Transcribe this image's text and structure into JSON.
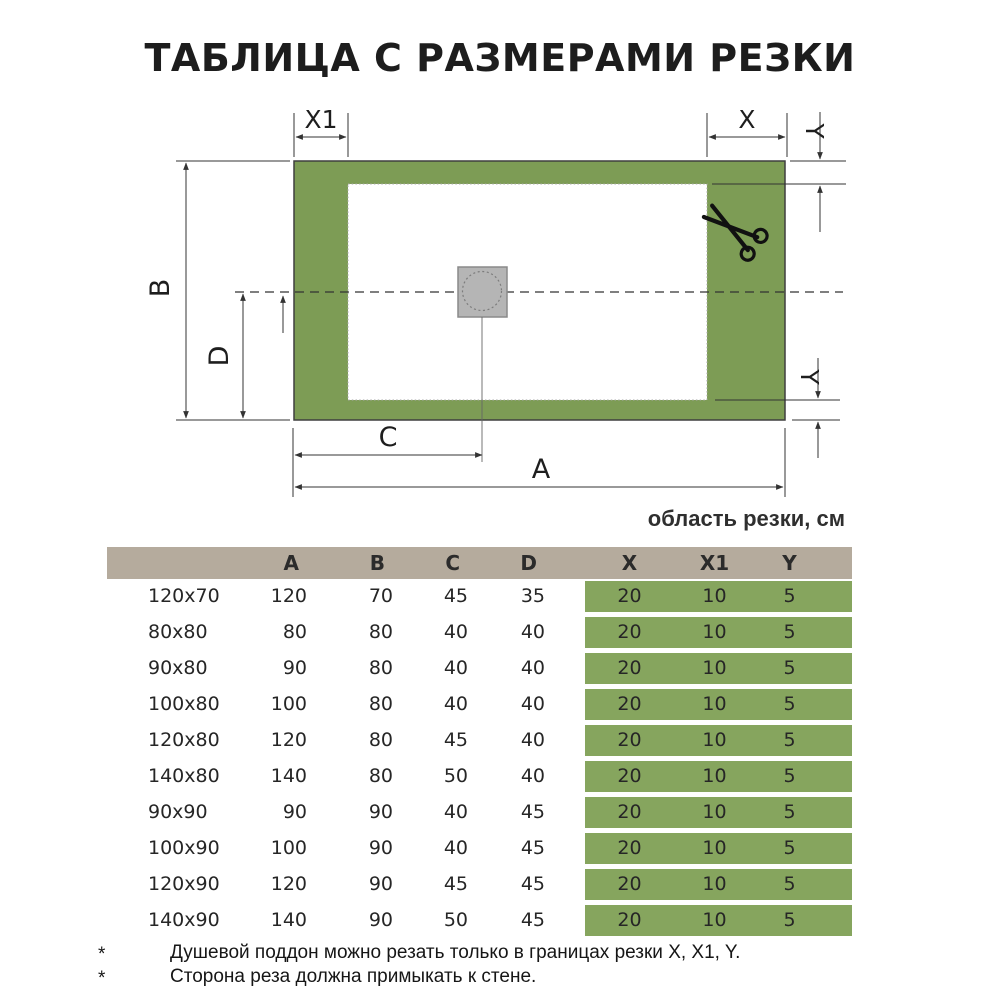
{
  "title": "ТАБЛИЦА С РАЗМЕРАМИ РЕЗКИ",
  "diagram": {
    "labels": {
      "x1": "X1",
      "x": "X",
      "y_top": "Y",
      "y_right": "Y",
      "b": "B",
      "d": "D",
      "c": "C",
      "a": "A"
    },
    "colors": {
      "tray": "#7d9c55",
      "drain_fill": "#b5b5b5",
      "line": "#3a3a3a"
    },
    "scissors_icon": "scissors"
  },
  "table": {
    "area_label": "область резки, см",
    "headers": {
      "size": "",
      "a": "A",
      "b": "B",
      "c": "C",
      "d": "D",
      "x": "X",
      "x1": "X1",
      "y": "Y"
    },
    "rows": [
      {
        "size": "120x70",
        "a": "120",
        "b": "70",
        "c": "45",
        "d": "35",
        "x": "20",
        "x1": "10",
        "y": "5"
      },
      {
        "size": "80x80",
        "a": "80",
        "b": "80",
        "c": "40",
        "d": "40",
        "x": "20",
        "x1": "10",
        "y": "5"
      },
      {
        "size": "90x80",
        "a": "90",
        "b": "80",
        "c": "40",
        "d": "40",
        "x": "20",
        "x1": "10",
        "y": "5"
      },
      {
        "size": "100x80",
        "a": "100",
        "b": "80",
        "c": "40",
        "d": "40",
        "x": "20",
        "x1": "10",
        "y": "5"
      },
      {
        "size": "120x80",
        "a": "120",
        "b": "80",
        "c": "45",
        "d": "40",
        "x": "20",
        "x1": "10",
        "y": "5"
      },
      {
        "size": "140x80",
        "a": "140",
        "b": "80",
        "c": "50",
        "d": "40",
        "x": "20",
        "x1": "10",
        "y": "5"
      },
      {
        "size": "90x90",
        "a": "90",
        "b": "90",
        "c": "40",
        "d": "45",
        "x": "20",
        "x1": "10",
        "y": "5"
      },
      {
        "size": "100x90",
        "a": "100",
        "b": "90",
        "c": "40",
        "d": "45",
        "x": "20",
        "x1": "10",
        "y": "5"
      },
      {
        "size": "120x90",
        "a": "120",
        "b": "90",
        "c": "45",
        "d": "45",
        "x": "20",
        "x1": "10",
        "y": "5"
      },
      {
        "size": "140x90",
        "a": "140",
        "b": "90",
        "c": "50",
        "d": "45",
        "x": "20",
        "x1": "10",
        "y": "5"
      }
    ],
    "colors": {
      "header_bg": "#b5ab9d",
      "cut_bg": "#86a55e"
    }
  },
  "footnotes": [
    {
      "marker": "*",
      "text": "Душевой поддон можно резать только в границах резки X, X1, Y."
    },
    {
      "marker": "*",
      "text": "Сторона реза должна примыкать к стене."
    }
  ]
}
